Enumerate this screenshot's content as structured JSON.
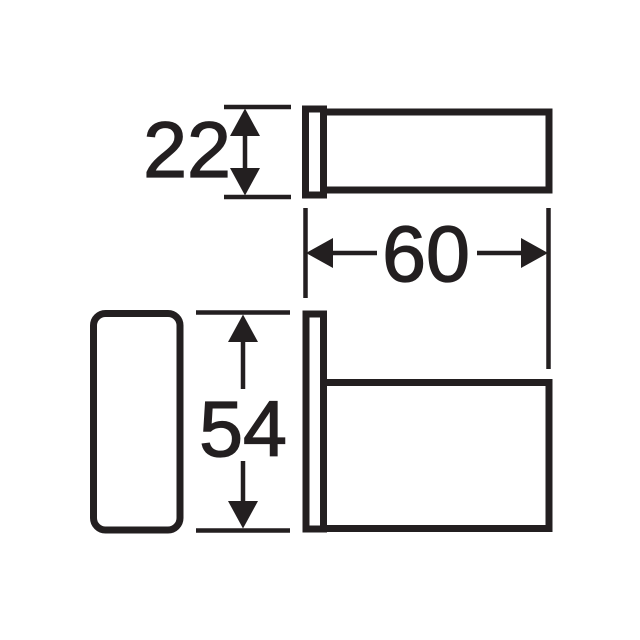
{
  "drawing": {
    "kind": "technical-dimension-drawing",
    "ink_color": "#231f20",
    "background_color": "#ffffff",
    "views": {
      "top": "top-view-of-wall-hook",
      "front": "front-view-of-wall-plate",
      "side": "side-view-of-wall-hook"
    },
    "dimensions": {
      "plate_width": {
        "value": "22",
        "orientation": "vertical"
      },
      "hook_depth": {
        "value": "60",
        "orientation": "horizontal"
      },
      "plate_height": {
        "value": "54",
        "orientation": "vertical"
      }
    }
  }
}
